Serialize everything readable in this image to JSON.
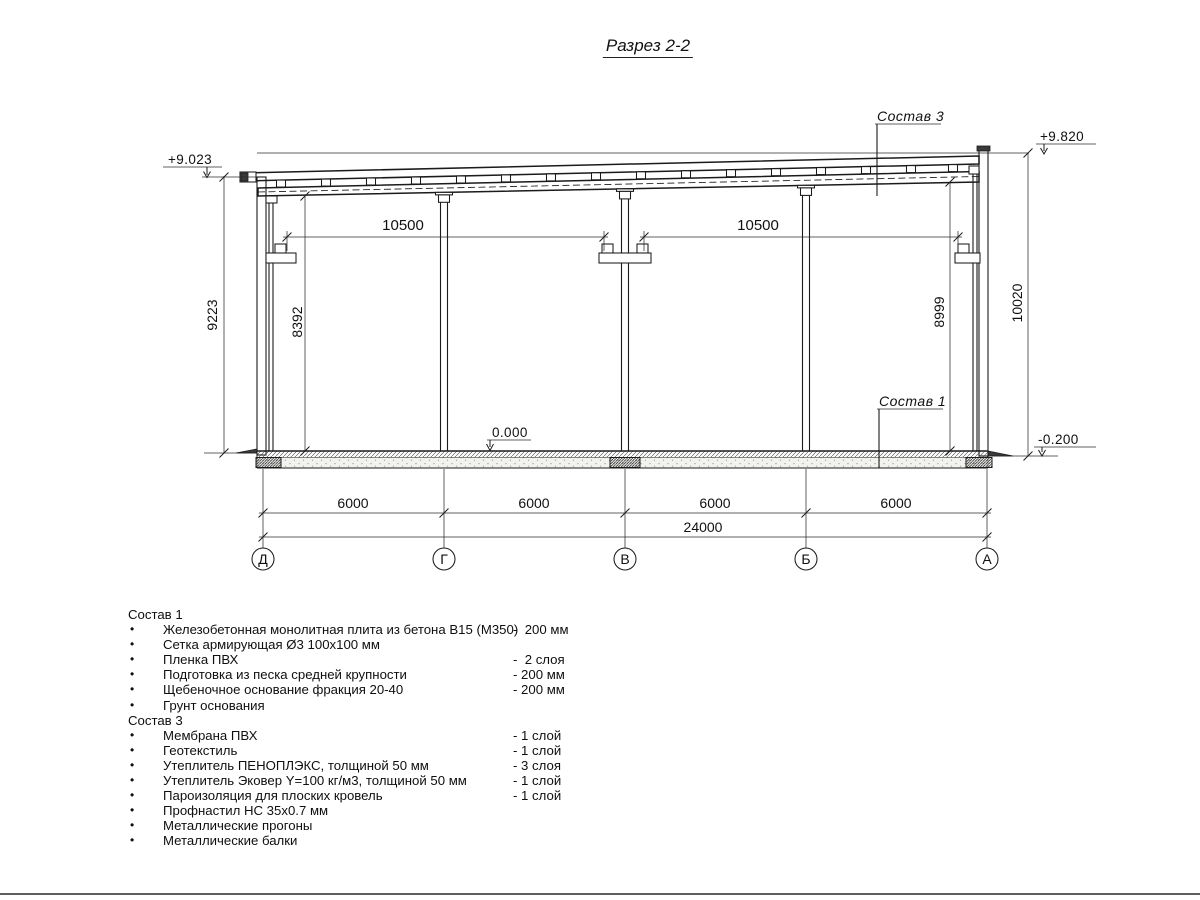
{
  "title": "Разрез 2-2",
  "colors": {
    "line": "#1b1b1b",
    "bottom_rule": "#5f5f5f",
    "background": "#ffffff"
  },
  "drawing": {
    "elevations": {
      "left": "+9.023",
      "right_top": "+9.820",
      "floor": "0.000",
      "ground": "-0.200"
    },
    "leaders": {
      "sostav3": "Состав 3",
      "sostav1": "Состав 1"
    },
    "dims": {
      "span_left": "10500",
      "span_right": "10500",
      "v_left_outer": "9223",
      "v_left_inner": "8392",
      "v_right_inner": "8999",
      "v_right_outer": "10020",
      "bay1": "6000",
      "bay2": "6000",
      "bay3": "6000",
      "bay4": "6000",
      "total": "24000"
    },
    "axes": [
      "Д",
      "Г",
      "В",
      "Б",
      "А"
    ]
  },
  "notes": {
    "bullet": "•",
    "sostav1": {
      "header": "Состав 1",
      "items": [
        {
          "text": "Железобетонная монолитная плита из бетона В15 (М350)",
          "qty": "-  200 мм"
        },
        {
          "text": "Сетка армирующая Ø3 100х100 мм",
          "qty": ""
        },
        {
          "text": "Пленка ПВХ",
          "qty": "-  2 слоя"
        },
        {
          "text": "Подготовка из песка средней крупности",
          "qty": "- 200 мм"
        },
        {
          "text": "Щебеночное основание фракция 20-40",
          "qty": "- 200 мм"
        },
        {
          "text": "Грунт основания",
          "qty": ""
        }
      ]
    },
    "sostav3": {
      "header": "Состав 3",
      "items": [
        {
          "text": "Мембрана ПВХ",
          "qty": "- 1 слой"
        },
        {
          "text": "Геотекстиль",
          "qty": "- 1 слой"
        },
        {
          "text": "Утеплитель ПЕНОПЛЭКС, толщиной 50 мм",
          "qty": "- 3 слоя"
        },
        {
          "text": "Утеплитель Эковер Y=100 кг/м3, толщиной 50 мм",
          "qty": "- 1 слой"
        },
        {
          "text": "Пароизоляция для плоских кровель",
          "qty": "- 1 слой"
        },
        {
          "text": "Профнастил НС 35х0.7 мм",
          "qty": ""
        },
        {
          "text": "Металлические прогоны",
          "qty": ""
        },
        {
          "text": "Металлические балки",
          "qty": ""
        }
      ]
    }
  }
}
